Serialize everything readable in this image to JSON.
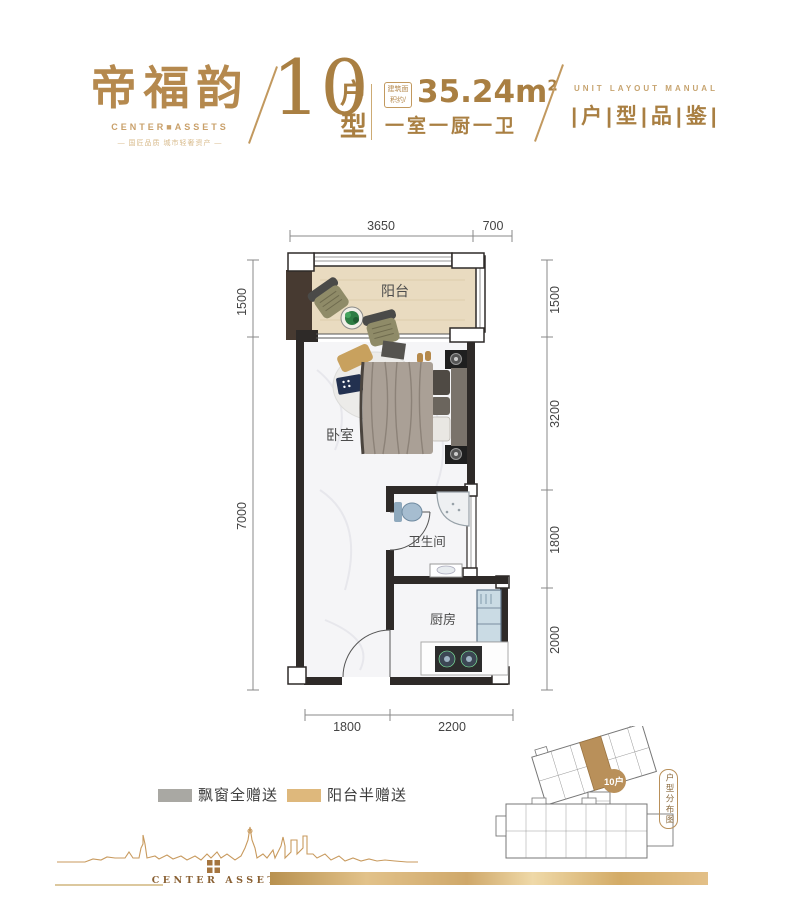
{
  "header": {
    "logo": {
      "title": "帝福韵",
      "subtitle": "CENTER■ASSETS",
      "tagline": "— 国匠品质 城市轻奢资产 —"
    },
    "unit": {
      "number": "10",
      "label_top": "户",
      "label_bottom": "型"
    },
    "area": {
      "box_line1": "建筑面",
      "box_line2": "积约/",
      "value": "35.24m",
      "sup": "2",
      "rooms": "一室一厨一卫"
    },
    "collection": {
      "en": "UNIT LAYOUT MANUAL",
      "cn": "|户|型|品|鉴|"
    }
  },
  "plan": {
    "rooms": {
      "balcony": "阳台",
      "bedroom": "卧室",
      "bathroom": "卫生间",
      "kitchen": "厨房"
    },
    "dims": {
      "top": [
        "3650",
        "700"
      ],
      "left": [
        "1500",
        "7000"
      ],
      "right": [
        "1500",
        "3200",
        "1800",
        "2000"
      ],
      "bottom": [
        "1800",
        "2200"
      ]
    }
  },
  "legend": {
    "items": [
      {
        "label": "飘窗全赠送",
        "color": "#a9a8a3"
      },
      {
        "label": "阳台半赠送",
        "color": "#deb87c"
      }
    ]
  },
  "minimap": {
    "badge": "10户",
    "capsule_label": "户型分布图"
  },
  "footer": {
    "brand": "CENTER ASSETS"
  },
  "colors": {
    "gold": "#b5894e",
    "gold_dark": "#a97f42",
    "wall": "#2e2a28",
    "balcony_floor": "#e9dbc0",
    "legend_gray": "#a9a8a3",
    "legend_gold": "#deb87c"
  }
}
